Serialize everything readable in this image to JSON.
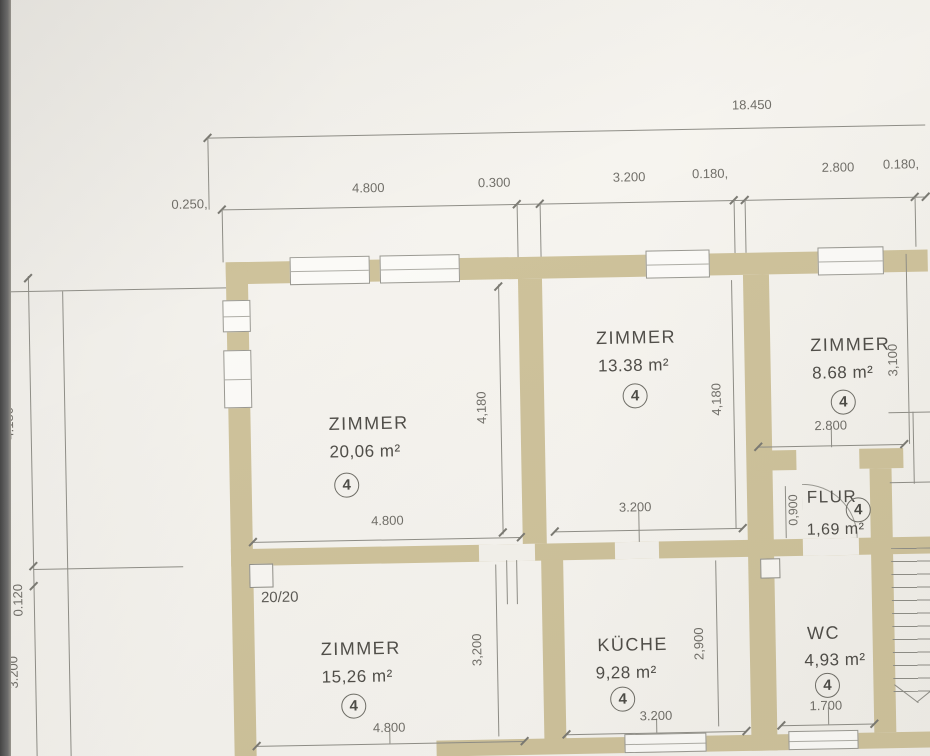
{
  "title_dims": {
    "overall": "18.450",
    "pre": "0.250,",
    "segments": [
      "4.800",
      "0.300",
      "3.200",
      "0.180,",
      "2.800",
      "0.180,"
    ]
  },
  "rooms": {
    "zimmer_nw": {
      "name": "ZIMMER",
      "area": "20,06 m²",
      "tag": "4",
      "dim_bottom": "4.800",
      "dim_side": "4,180"
    },
    "zimmer_n": {
      "name": "ZIMMER",
      "area": "13.38 m²",
      "tag": "4",
      "dim_bottom": "3.200",
      "dim_side": "4,180"
    },
    "zimmer_ne": {
      "name": "ZIMMER",
      "area": "8.68 m²",
      "tag": "4",
      "dim_bottom": "2.800",
      "dim_side": "3,100"
    },
    "flur": {
      "name": "FLUR",
      "area": "1,69 m²",
      "tag": "4",
      "dim_side": "0,900"
    },
    "zimmer_sw": {
      "name": "ZIMMER",
      "area": "15,26 m²",
      "tag": "4",
      "dim_bottom": "4.800",
      "dim_side": "3,200"
    },
    "kueche": {
      "name": "KÜCHE",
      "area": "9,28 m²",
      "tag": "4",
      "dim_bottom": "3.200",
      "dim_side": "2,900"
    },
    "wc": {
      "name": "WC",
      "area": "4,93 m²",
      "tag": "4",
      "dim_bottom": "1.700"
    }
  },
  "left_dims": {
    "upper": "4.180",
    "middle": "0.120",
    "lower": "3.200"
  },
  "annotations": {
    "stair_note": "20/20"
  },
  "colors": {
    "wall": "#cec29b",
    "line": "#8f8e87",
    "dim_text": "#716f69",
    "room_text": "#504e49",
    "paper": "#f3f1ec",
    "edge": "#4a4a4a"
  }
}
